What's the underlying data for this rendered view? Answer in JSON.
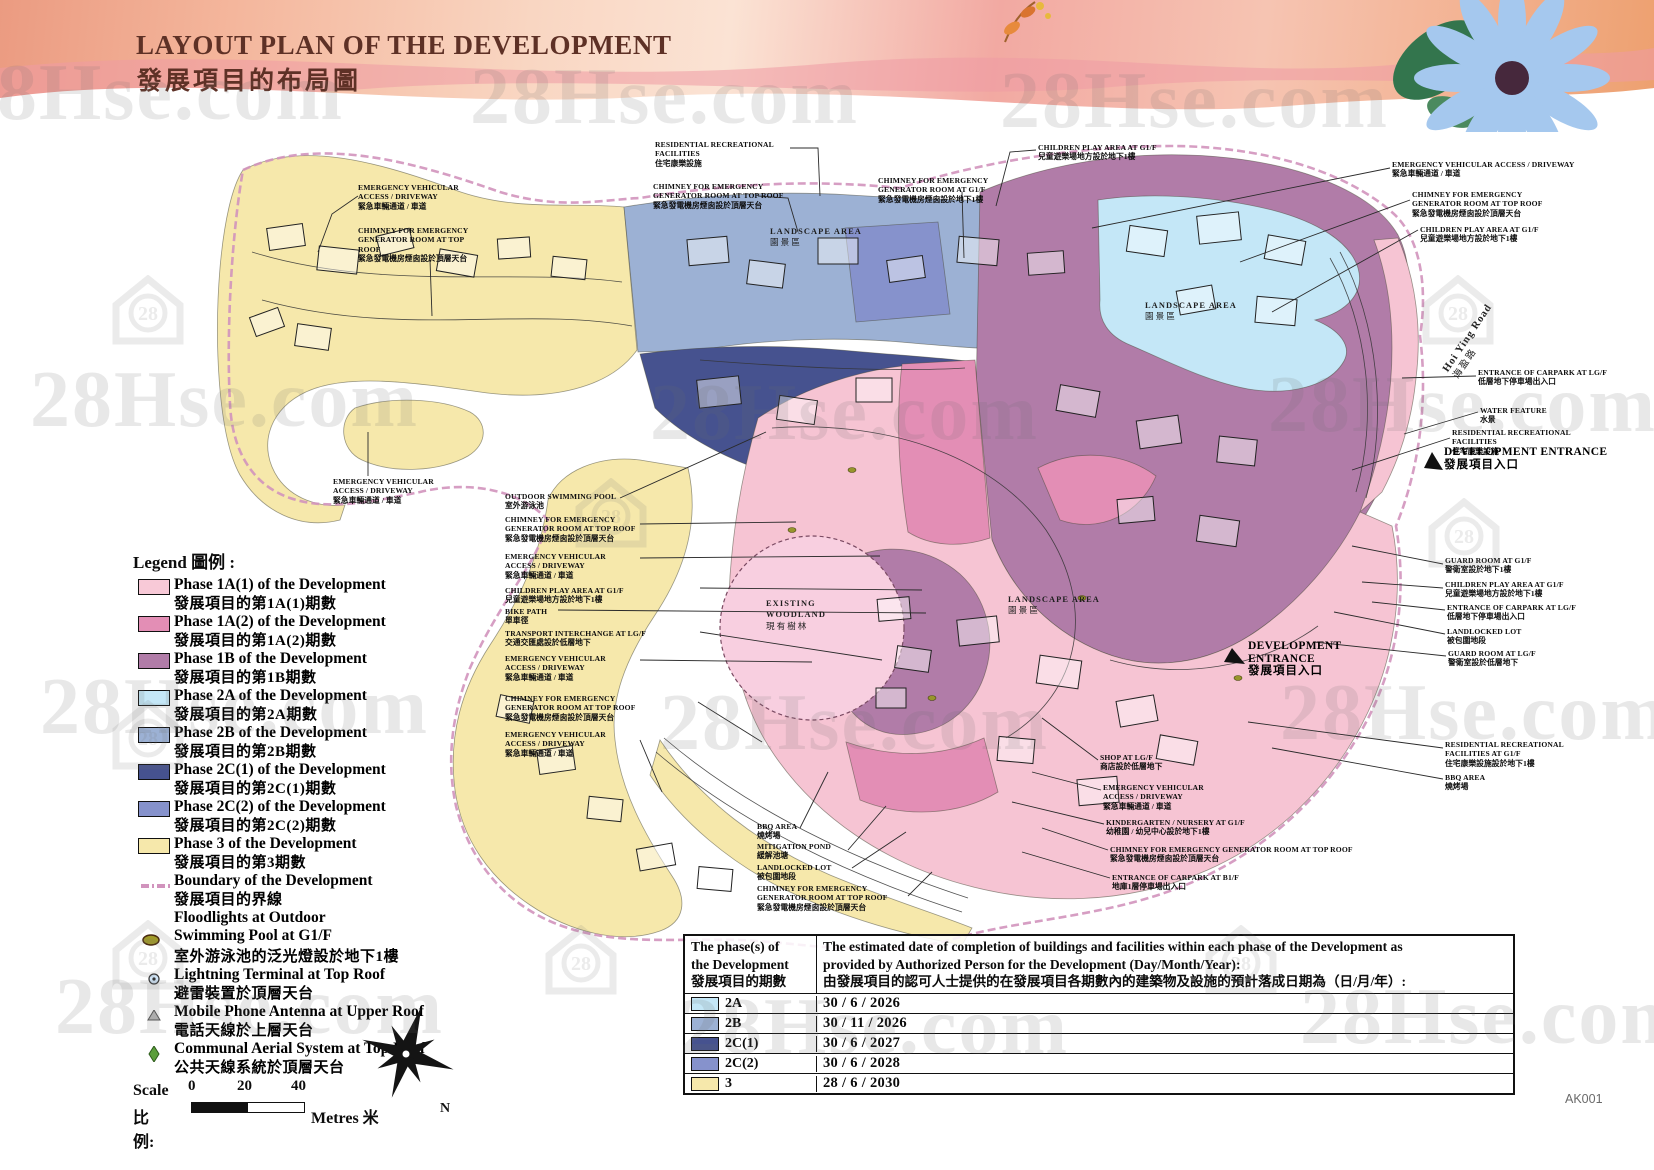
{
  "page": {
    "title_en": "LAYOUT PLAN OF THE DEVELOPMENT",
    "title_zh": "發展項目的布局圖",
    "code": "AK001"
  },
  "watermark": {
    "text": "28Hse.com",
    "badge": "28"
  },
  "legend": {
    "heading": "Legend 圖例 :",
    "phases": [
      {
        "en": "Phase 1A(1) of the Development",
        "zh": "發展項目的第1A(1)期數",
        "color": "#f8c9d7"
      },
      {
        "en": "Phase 1A(2) of the Development",
        "zh": "發展項目的第1A(2)期數",
        "color": "#e38eb5"
      },
      {
        "en": "Phase 1B of the Development",
        "zh": "發展項目的第1B期數",
        "color": "#b17ca8"
      },
      {
        "en": "Phase 2A of the Development",
        "zh": "發展項目的第2A期數",
        "color": "#c4e7f7"
      },
      {
        "en": "Phase 2B of the Development",
        "zh": "發展項目的第2B期數",
        "color": "#9cb1d4"
      },
      {
        "en": "Phase 2C(1) of the Development",
        "zh": "發展項目的第2C(1)期數",
        "color": "#46528f"
      },
      {
        "en": "Phase 2C(2) of the Development",
        "zh": "發展項目的第2C(2)期數",
        "color": "#8692cc"
      },
      {
        "en": "Phase 3 of the Development",
        "zh": "發展項目的第3期數",
        "color": "#f6e8ab"
      }
    ],
    "boundary": {
      "en": "Boundary of the Development",
      "zh": "發展項目的界線",
      "color": "#d193bd"
    },
    "floodlight": {
      "en1": "Floodlights at Outdoor",
      "en2": "Swimming Pool at G1/F",
      "zh": "室外游泳池的泛光燈設於地下1樓"
    },
    "lightning": {
      "en": "Lightning Terminal at Top Roof",
      "zh": "避雷裝置於頂層天台"
    },
    "antenna": {
      "en": "Mobile Phone Antenna at Upper Roof",
      "zh": "電話天線於上層天台"
    },
    "aerial": {
      "en": "Communal Aerial System at Top Roof",
      "zh": "公共天線系統於頂層天台"
    },
    "scale_label_en": "Scale",
    "scale_label_zh": "比例:",
    "scale_ticks": [
      "0",
      "20",
      "40"
    ],
    "scale_unit": "Metres 米",
    "north": "N"
  },
  "map_labels": {
    "landscape": {
      "en": "LANDSCAPE AREA",
      "zh": "園景區"
    },
    "woodland": {
      "en1": "EXISTING",
      "en2": "WOODLAND",
      "zh": "現有樹林"
    },
    "road": {
      "en": "Hoi Ying Road",
      "zh": "海盈路"
    }
  },
  "entrance": {
    "en": "DEVELOPMENT ENTRANCE",
    "zh": "發展項目入口"
  },
  "callouts": [
    {
      "en": "EMERGENCY VEHICULAR ACCESS / DRIVEWAY",
      "zh": "緊急車輛通道 / 車道"
    },
    {
      "en": "CHIMNEY FOR EMERGENCY GENERATOR ROOM AT TOP ROOF",
      "zh": "緊急發電機房煙囪設於頂層天台"
    },
    {
      "en": "RESIDENTIAL RECREATIONAL FACILITIES",
      "zh": "住宅康樂設施"
    },
    {
      "en": "CHIMNEY FOR EMERGENCY GENERATOR ROOM AT TOP ROOF",
      "zh": "緊急發電機房煙囪設於頂層天台"
    },
    {
      "en": "CHIMNEY FOR EMERGENCY GENERATOR ROOM AT G1/F",
      "zh": "緊急發電機房煙囪設於地下1樓"
    },
    {
      "en": "CHILDREN PLAY AREA AT G1/F",
      "zh": "兒童遊樂場地方設於地下1樓"
    },
    {
      "en": "EMERGENCY VEHICULAR ACCESS / DRIVEWAY",
      "zh": "緊急車輛通道 / 車道"
    },
    {
      "en": "CHIMNEY FOR EMERGENCY GENERATOR ROOM AT TOP ROOF",
      "zh": "緊急發電機房煙囪設於頂層天台"
    },
    {
      "en": "CHILDREN PLAY AREA AT G1/F",
      "zh": "兒童遊樂場地方設於地下1樓"
    },
    {
      "en": "ENTRANCE OF CARPARK AT LG/F",
      "zh": "低層地下停車場出入口"
    },
    {
      "en": "WATER FEATURE",
      "zh": "水景"
    },
    {
      "en": "RESIDENTIAL RECREATIONAL FACILITIES",
      "zh": "住宅康樂設施"
    },
    {
      "en": "GUARD ROOM AT G1/F",
      "zh": "警衛室設於地下1樓"
    },
    {
      "en": "CHILDREN PLAY AREA AT G1/F",
      "zh": "兒童遊樂場地方設於地下1樓"
    },
    {
      "en": "ENTRANCE OF CARPARK AT LG/F",
      "zh": "低層地下停車場出入口"
    },
    {
      "en": "LANDLOCKED LOT",
      "zh": "被包圍地段"
    },
    {
      "en": "GUARD ROOM AT LG/F",
      "zh": "警衛室設於低層地下"
    },
    {
      "en": "RESIDENTIAL RECREATIONAL FACILITIES AT G1/F",
      "zh": "住宅康樂設施設於地下1樓"
    },
    {
      "en": "BBQ AREA",
      "zh": "燒烤場"
    },
    {
      "en": "OUTDOOR SWIMMING POOL",
      "zh": "室外游泳池"
    },
    {
      "en": "CHIMNEY FOR EMERGENCY GENERATOR ROOM AT TOP ROOF",
      "zh": "緊急發電機房煙囪設於頂層天台"
    },
    {
      "en": "EMERGENCY VEHICULAR ACCESS / DRIVEWAY",
      "zh": "緊急車輛通道 / 車道"
    },
    {
      "en": "CHILDREN PLAY AREA AT G1/F",
      "zh": "兒童遊樂場地方設於地下1樓"
    },
    {
      "en": "BIKE PATH",
      "zh": "單車徑"
    },
    {
      "en": "TRANSPORT INTERCHANGE AT LG/F",
      "zh": "交通交匯處設於低層地下"
    },
    {
      "en": "EMERGENCY VEHICULAR ACCESS / DRIVEWAY",
      "zh": "緊急車輛通道 / 車道"
    },
    {
      "en": "CHIMNEY FOR EMERGENCY GENERATOR ROOM AT TOP ROOF",
      "zh": "緊急發電機房煙囪設於頂層天台"
    },
    {
      "en": "EMERGENCY VEHICULAR ACCESS / DRIVEWAY",
      "zh": "緊急車輛通道 / 車道"
    },
    {
      "en": "EMERGENCY VEHICULAR ACCESS / DRIVEWAY",
      "zh": "緊急車輛通道 / 車道"
    },
    {
      "en": "BBQ AREA",
      "zh": "燒烤場"
    },
    {
      "en": "MITIGATION POND",
      "zh": "緩解池塘"
    },
    {
      "en": "LANDLOCKED LOT",
      "zh": "被包圍地段"
    },
    {
      "en": "CHIMNEY FOR EMERGENCY GENERATOR ROOM AT TOP ROOF",
      "zh": "緊急發電機房煙囪設於頂層天台"
    },
    {
      "en": "SHOP AT LG/F",
      "zh": "商店設於低層地下"
    },
    {
      "en": "EMERGENCY VEHICULAR ACCESS / DRIVEWAY",
      "zh": "緊急車輛通道 / 車道"
    },
    {
      "en": "KINDERGARTEN / NURSERY AT G1/F",
      "zh": "幼稚園 / 幼兒中心設於地下1樓"
    },
    {
      "en": "CHIMNEY FOR EMERGENCY GENERATOR ROOM AT TOP ROOF",
      "zh": "緊急發電機房煙囪設於頂層天台"
    },
    {
      "en": "ENTRANCE OF CARPARK AT B1/F",
      "zh": "地庫1層停車場出入口"
    }
  ],
  "table": {
    "header": {
      "col1": [
        "The phase(s) of",
        "the Development",
        "發展項目的期數"
      ],
      "col2": [
        "The estimated date of completion of buildings and facilities within each phase of the Development as",
        "provided by Authorized Person for the Development (Day/Month/Year):",
        "由發展項目的認可人士提供的在發展項目各期數內的建築物及設施的預計落成日期為（日/月/年）:"
      ]
    },
    "rows": [
      {
        "phase": "2A",
        "date": "30 / 6 / 2026",
        "color": "#c4e7f7"
      },
      {
        "phase": "2B",
        "date": "30 / 11 / 2026",
        "color": "#9cb1d4"
      },
      {
        "phase": "2C(1)",
        "date": "30 / 6 / 2027",
        "color": "#46528f"
      },
      {
        "phase": "2C(2)",
        "date": "30 / 6 / 2028",
        "color": "#8692cc"
      },
      {
        "phase": "3",
        "date": "28 / 6 / 2030",
        "color": "#f6e8ab"
      }
    ]
  }
}
